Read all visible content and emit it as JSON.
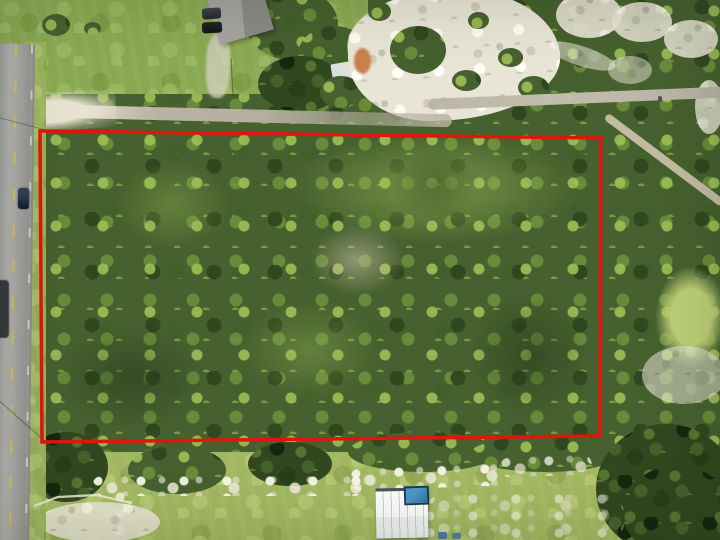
{
  "scene": {
    "kind": "aerial drone photograph",
    "subject": "wooded rectangular land parcel outlined with a red survey boundary",
    "surroundings": {
      "west": "two-lane asphalt road with dashed yellow centerline, dark car driving, dark truck at edge",
      "north": "mowed grass yard, gray-roofed building with two parked cars, dirt driveway, white sand clearing with green scrub and a rust-colored patch, dirt road with branch trail",
      "east": "scrub woods with small grassy clearing and pale sandy openings",
      "south": "grass field with white gravel streaks, white metal-roof shed with blue tarp, dark tree masses"
    },
    "palette": {
      "boundary": "#e3140a",
      "canopy": "#46602f",
      "canopyDark": "#31471f",
      "grass": "#9ab35c",
      "sand": "#e9e5d6",
      "asphalt": "#a6a6a3",
      "dirt": "#c9bda3",
      "roofGray": "#9a9995",
      "roofWhite": "#f2f3f1",
      "tarpBlue": "#2f6f9e",
      "lineYellow": "#d9c24a"
    }
  }
}
